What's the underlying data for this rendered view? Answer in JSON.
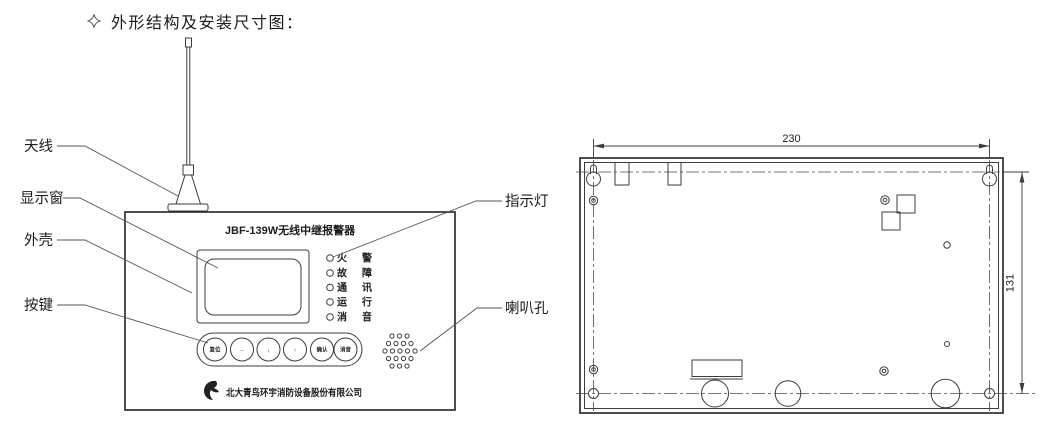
{
  "page": {
    "section_title": "外形结构及安装尺寸图："
  },
  "colors": {
    "ink": "#3c3c3c",
    "background": "#ffffff"
  },
  "front_view": {
    "device_title": "JBF-139W无线中继报警器",
    "company_name": "北大青鸟环宇消防设备股份有限公司",
    "callouts": {
      "antenna": "天线",
      "display_window": "显示窗",
      "housing": "外壳",
      "keys": "按键",
      "indicator_light": "指示灯",
      "speaker_hole": "喇叭孔"
    },
    "indicators": [
      "火警",
      "故障",
      "通讯",
      "运行",
      "消音"
    ],
    "buttons": [
      "复位",
      "→",
      "↓",
      "↑",
      "确认",
      "消音"
    ]
  },
  "rear_view": {
    "width_dim": "230",
    "height_dim": "131"
  }
}
